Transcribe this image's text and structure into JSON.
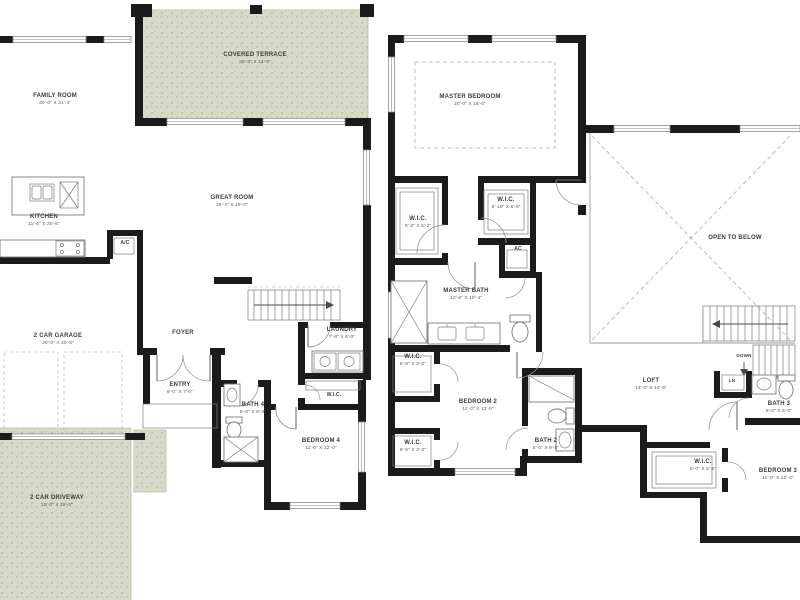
{
  "plan": {
    "first_floor": {
      "family_room": {
        "name": "FAMILY ROOM",
        "dims": "20'-0\" X 31'-4\""
      },
      "covered_terrace": {
        "name": "COVERED TERRACE",
        "dims": "26'-8\" X 14'-0\""
      },
      "kitchen": {
        "name": "KITCHEN",
        "dims": "11'-4\" X 20'-6\""
      },
      "ac_closet": {
        "name": "A/C"
      },
      "great_room": {
        "name": "GREAT ROOM",
        "dims": "26'-4\" X 19'-0\""
      },
      "garage": {
        "name": "2 CAR GARAGE",
        "dims": "20'-0\" X 20'-0\""
      },
      "foyer": {
        "name": "FOYER"
      },
      "entry": {
        "name": "ENTRY",
        "dims": "9'-0\" X 7'-0\""
      },
      "laundry": {
        "name": "LAUNDRY",
        "dims": "7'-6\" X 6'-0\""
      },
      "wic": {
        "name": "W.I.C."
      },
      "bath_4": {
        "name": "BATH 4",
        "dims": "5'-0\" X 9'-4\""
      },
      "bedroom_4": {
        "name": "BEDROOM 4",
        "dims": "11'-0\" X 12'-0\""
      },
      "driveway": {
        "name": "2 CAR DRIVEWAY",
        "dims": "18'-0\" X 18'-0\""
      }
    },
    "second_floor": {
      "master_bedroom": {
        "name": "MASTER BEDROOM",
        "dims": "20'-0\" X 15'-0\""
      },
      "wic_1": {
        "name": "W.I.C.",
        "dims": "9'-2\" X 5'-2\""
      },
      "wic_2": {
        "name": "W.I.C.",
        "dims": "5'-10\" X 5'-8\""
      },
      "ac_closet": {
        "name": "AC"
      },
      "master_bath": {
        "name": "MASTER BATH",
        "dims": "12'-6\" X 10'-4\""
      },
      "wic_3": {
        "name": "W.I.C.",
        "dims": "6'-5\" X 3'-2\""
      },
      "bedroom_2": {
        "name": "BEDROOM 2",
        "dims": "11'-0\" X 13'-0\""
      },
      "wic_4": {
        "name": "W.I.C.",
        "dims": "6'-5\" X 3'-2\""
      },
      "bath_2": {
        "name": "BATH 2",
        "dims": "5'-0\" X 9'-8\""
      },
      "loft": {
        "name": "LOFT",
        "dims": "14'-0\" X 10'-6\""
      },
      "open_to_below": {
        "name": "OPEN TO BELOW"
      },
      "down": {
        "name": "DOWN"
      },
      "linen": {
        "name": "LN"
      },
      "bath_3": {
        "name": "BATH 3",
        "dims": "8'-0\" X 5'-0\""
      },
      "wic_5": {
        "name": "W.I.C.",
        "dims": "5'-0\" X 5'-6\""
      },
      "bedroom_3": {
        "name": "BEDROOM 3",
        "dims": "11'-0\" X 12'-4\""
      }
    },
    "colors": {
      "wall": "#1b1b1b",
      "line": "#9a9a9a",
      "text": "#3c3c3c",
      "texture_base": "#d9dbca",
      "texture_speckle": "#b9bda8",
      "texture_speckle_light": "#cbcfba"
    }
  }
}
